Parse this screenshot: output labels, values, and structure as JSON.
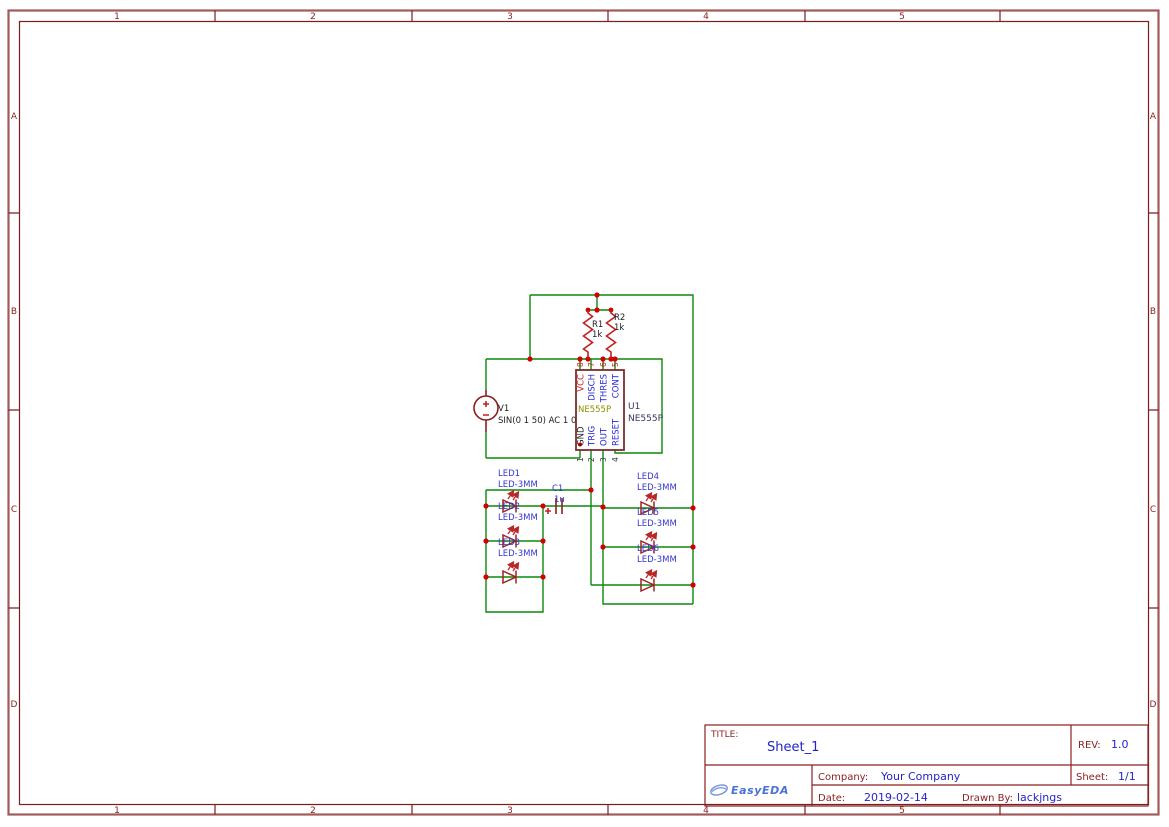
{
  "frame": {
    "columns": [
      "1",
      "2",
      "3",
      "4",
      "5"
    ],
    "rows": [
      "A",
      "B",
      "C",
      "D"
    ]
  },
  "title_block": {
    "title_label": "TITLE:",
    "title": "Sheet_1",
    "rev_label": "REV:",
    "rev": "1.0",
    "company_label": "Company:",
    "company": "Your Company",
    "sheet_label": "Sheet:",
    "sheet": "1/1",
    "date_label": "Date:",
    "date": "2019-02-14",
    "drawn_by_label": "Drawn By:",
    "drawn_by": "lackjngs",
    "logo_text": "EasyEDA"
  },
  "schematic": {
    "v1": {
      "ref": "V1",
      "value": "SIN(0 1 50) AC 1 0"
    },
    "r1": {
      "ref": "R1",
      "value": "1k"
    },
    "r2": {
      "ref": "R2",
      "value": "1k"
    },
    "c1": {
      "ref": "C1",
      "value": "1u"
    },
    "u1": {
      "ref": "U1",
      "value": "NE555P",
      "part_label": "NE555P",
      "pins_top": [
        {
          "num": "8",
          "name": "VCC"
        },
        {
          "num": "7",
          "name": "DISCH"
        },
        {
          "num": "6",
          "name": "THRES"
        },
        {
          "num": "5",
          "name": "CONT"
        }
      ],
      "pins_bottom": [
        {
          "num": "1",
          "name": "GND"
        },
        {
          "num": "2",
          "name": "TRIG"
        },
        {
          "num": "3",
          "name": "OUT"
        },
        {
          "num": "4",
          "name": "RESET"
        }
      ]
    },
    "leds": [
      {
        "ref": "LED1",
        "value": "LED-3MM"
      },
      {
        "ref": "LED2",
        "value": "LED-3MM"
      },
      {
        "ref": "LED3",
        "value": "LED-3MM"
      },
      {
        "ref": "LED4",
        "value": "LED-3MM"
      },
      {
        "ref": "LED5",
        "value": "LED-3MM"
      },
      {
        "ref": "LED6",
        "value": "LED-3MM"
      }
    ]
  },
  "colors": {
    "wire_green": "#0a8a0a",
    "junction_red": "#d40000",
    "frame_maroon": "#7c1d1d",
    "value_blue": "#2323cc",
    "component_label_blue": "#3434d0",
    "pin_label_blue": "#2525d8",
    "component_red": "#c22020",
    "ic_border_red": "#7d2b2b",
    "part_olive": "#8f8f00",
    "logo_blue": "#4a72d8"
  }
}
